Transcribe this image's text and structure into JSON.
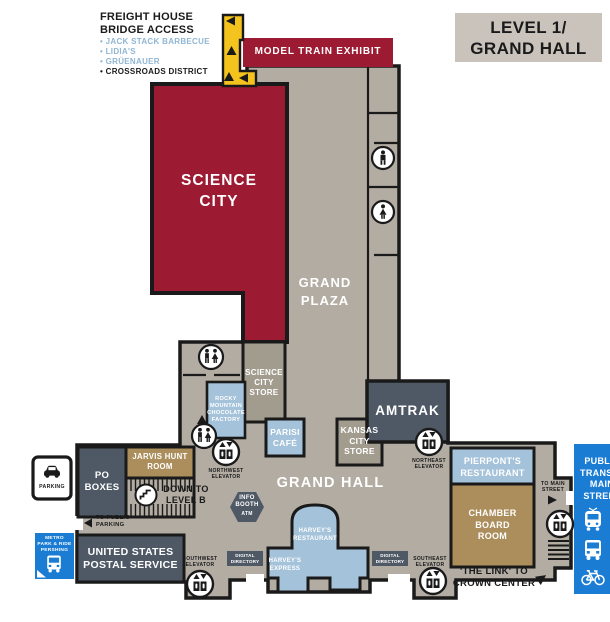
{
  "title_badge": "LEVEL 1/\nGRAND HALL",
  "legend": {
    "title": "FREIGHT HOUSE\nBRIDGE ACCESS",
    "items": [
      {
        "label": "• JACK STACK BARBECUE",
        "color": "blue"
      },
      {
        "label": "• LIDIA'S",
        "color": "blue"
      },
      {
        "label": "• GRÜENAUER",
        "color": "blue"
      },
      {
        "label": "• CROSSROADS DISTRICT",
        "color": "black"
      }
    ]
  },
  "rooms": {
    "model_train": "MODEL TRAIN EXHIBIT",
    "science_city": "SCIENCE\nCITY",
    "grand_plaza": "GRAND\nPLAZA",
    "science_city_store": "SCIENCE\nCITY\nSTORE",
    "rocky_mountain": "ROCKY\nMOUNTAIN\nCHOCOLATE\nFACTORY",
    "parisi_cafe": "PARISI\nCAFÉ",
    "kansas_city_store": "KANSAS\nCITY\nSTORE",
    "amtrak": "AMTRAK",
    "jarvis_hunt": "JARVIS HUNT\nROOM",
    "po_boxes": "PO\nBOXES",
    "usps": "UNITED STATES\nPOSTAL SERVICE",
    "grand_hall": "GRAND HALL",
    "harveys_restaurant": "HARVEY'S\nRESTAURANT",
    "harveys_express": "HARVEY'S\nEXPRESS",
    "pierponts": "PIERPONT'S\nRESTAURANT",
    "chamber": "CHAMBER\nBOARD\nROOM"
  },
  "poi": {
    "down_to_level_b": "DOWN TO\nLEVEL B",
    "info_booth": "INFO\nBOOTH",
    "atm": "ATM",
    "digital_directory": "DIGITAL\nDIRECTORY",
    "nw_elevator": "NORTHWEST\nELEVATOR",
    "ne_elevator": "NORTHEAST\nELEVATOR",
    "sw_elevator": "SOUTHWEST\nELEVATOR",
    "se_elevator": "SOUTHEAST\nELEVATOR",
    "to_public_parking": "TO PUBLIC\nPARKING",
    "to_main_street": "TO MAIN\nSTREET",
    "the_link": "'THE LINK' TO\nCROWN CENTER",
    "parking": "PARKING",
    "metro": "METRO\nPARK & RIDE\nPERSHING",
    "public_transit": "PUBLIC\nTRANSIT/\nMAIN\nSTREET"
  },
  "icons": {
    "restrooms": "men-women-restroom",
    "mens_restroom": "man",
    "womens_restroom": "woman",
    "elevator": "elevator",
    "stairs_down": "stairs-spiral",
    "parking": "car",
    "metro": "bus",
    "transit": [
      "streetcar",
      "bus",
      "bicycle"
    ]
  },
  "colors": {
    "red": "#9C1B33",
    "floor_gray": "#B3ACA3",
    "store_tan_gray": "#A29C8F",
    "light_blue": "#A4C2DA",
    "dark_slate": "#4F5966",
    "tan": "#AC8E5D",
    "bright_blue": "#1B7CD4",
    "yellow": "#F5C31D",
    "badge_gray": "#C9C3BC",
    "wall_black": "#1a1a1a",
    "legend_blue": "#8FB6D4"
  }
}
